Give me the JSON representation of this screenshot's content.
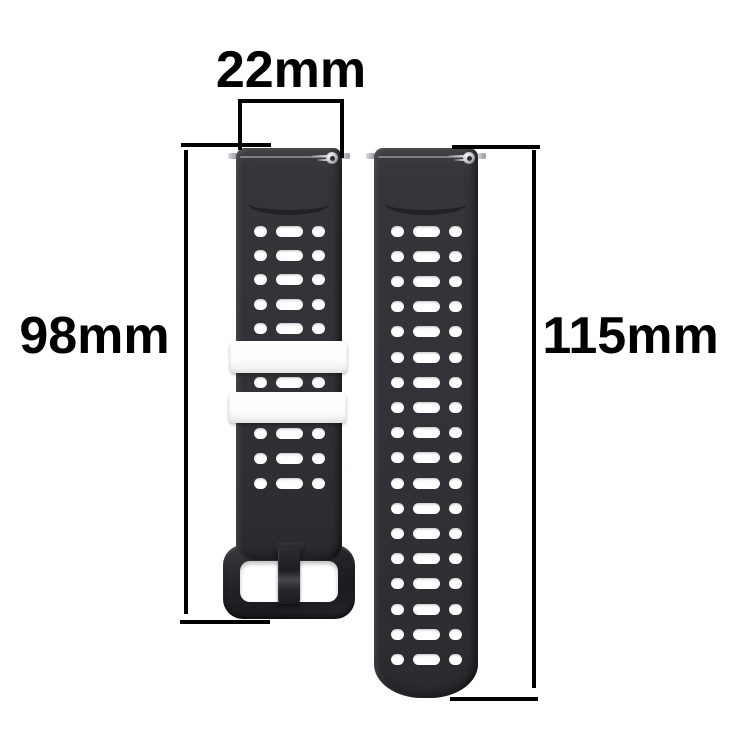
{
  "annotations": {
    "width_label": "22mm",
    "left_length_label": "98mm",
    "right_length_label": "115mm"
  },
  "buckle_strap": {
    "hole_rows_above_keepers": 5,
    "hole_rows_between_keepers": 1,
    "hole_rows_below_keepers": 3,
    "holes_per_row": 3,
    "keeper_count": 2
  },
  "hole_strap": {
    "hole_rows": 18,
    "holes_per_row": 3
  },
  "colors": {
    "background": "#ffffff",
    "annotation": "#000000",
    "strap": "#323338",
    "buckle": "#232428",
    "keeper": "#ffffff",
    "hardware": "#c9ccd0",
    "hole": "#ffffff"
  }
}
